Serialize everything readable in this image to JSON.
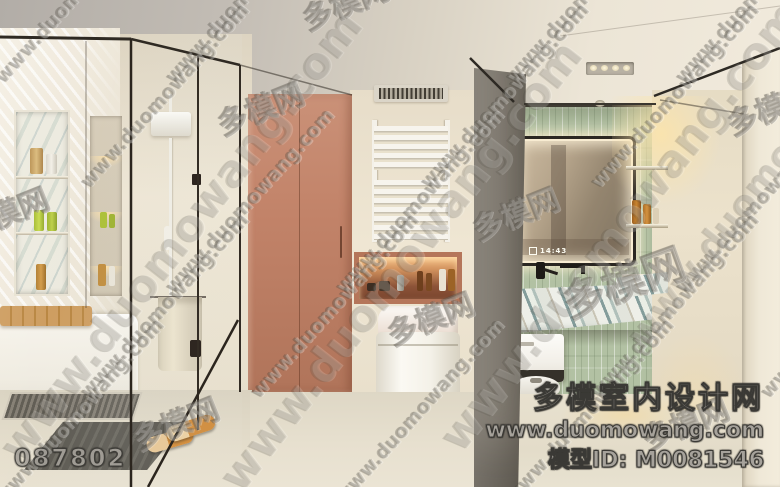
{
  "watermark": {
    "url_text": "www.duomowang.com",
    "stamp_text": "多模网",
    "footer": {
      "site_name": "多模室内设计网",
      "site_url": "www.duomowang.com",
      "model_id": "模型ID: M0081546",
      "image_number": "087802"
    }
  },
  "mirror": {
    "clock_time": "14:43"
  },
  "palette": {
    "terracotta_cabinet": "#bd7f63",
    "niche_glow": "#f0b77e",
    "green_tile": "#b2c1a3",
    "marble_vein_teal": "#5d7f83",
    "ceiling_gray": "#b5b0a9",
    "cream_wall": "#ebe2d0",
    "floor": "#e2dbc9",
    "column_gray": "#857f76",
    "warm_light": "#f4dda8",
    "slipper_orange": "#d28a35",
    "watermark_gray": "#a6a29b"
  }
}
